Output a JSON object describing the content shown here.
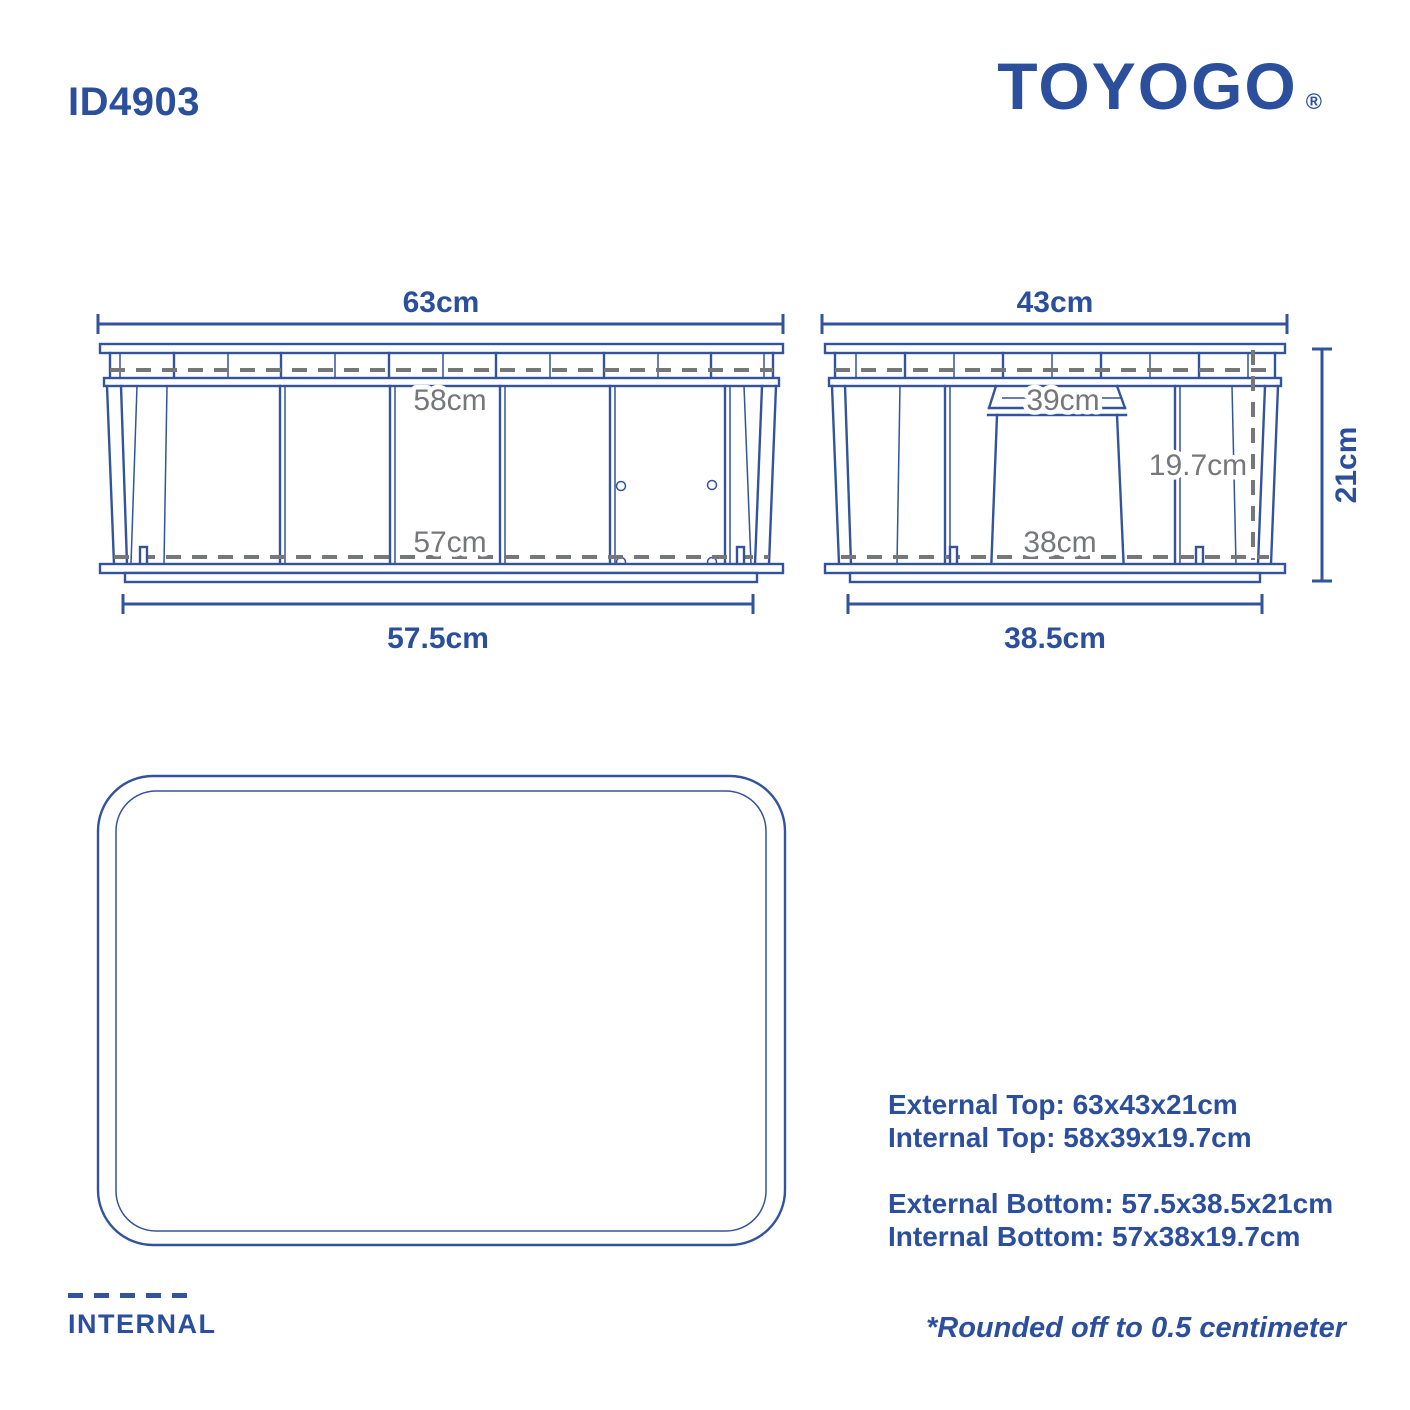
{
  "header": {
    "product_id": "ID4903",
    "brand": "TOYOGO",
    "registered_mark": "®"
  },
  "front_view": {
    "dim_external_top": "63cm",
    "dim_internal_top": "58cm",
    "dim_internal_bottom": "57cm",
    "dim_external_bottom": "57.5cm"
  },
  "side_view": {
    "dim_external_top": "43cm",
    "dim_internal_top": "39cm",
    "dim_internal_height": "19.7cm",
    "dim_internal_bottom": "38cm",
    "dim_external_bottom": "38.5cm",
    "dim_external_height": "21cm"
  },
  "specs": {
    "external_top": "External Top: 63x43x21cm",
    "internal_top": "Internal Top: 58x39x19.7cm",
    "external_bottom": "External Bottom: 57.5x38.5x21cm",
    "internal_bottom": "Internal Bottom: 57x38x19.7cm"
  },
  "legend": {
    "label": "INTERNAL"
  },
  "footnote": "*Rounded off to 0.5 centimeter",
  "colors": {
    "line_navy": "#33539c",
    "text_navy": "#2b4f9c",
    "dim_gray": "#76777b"
  }
}
